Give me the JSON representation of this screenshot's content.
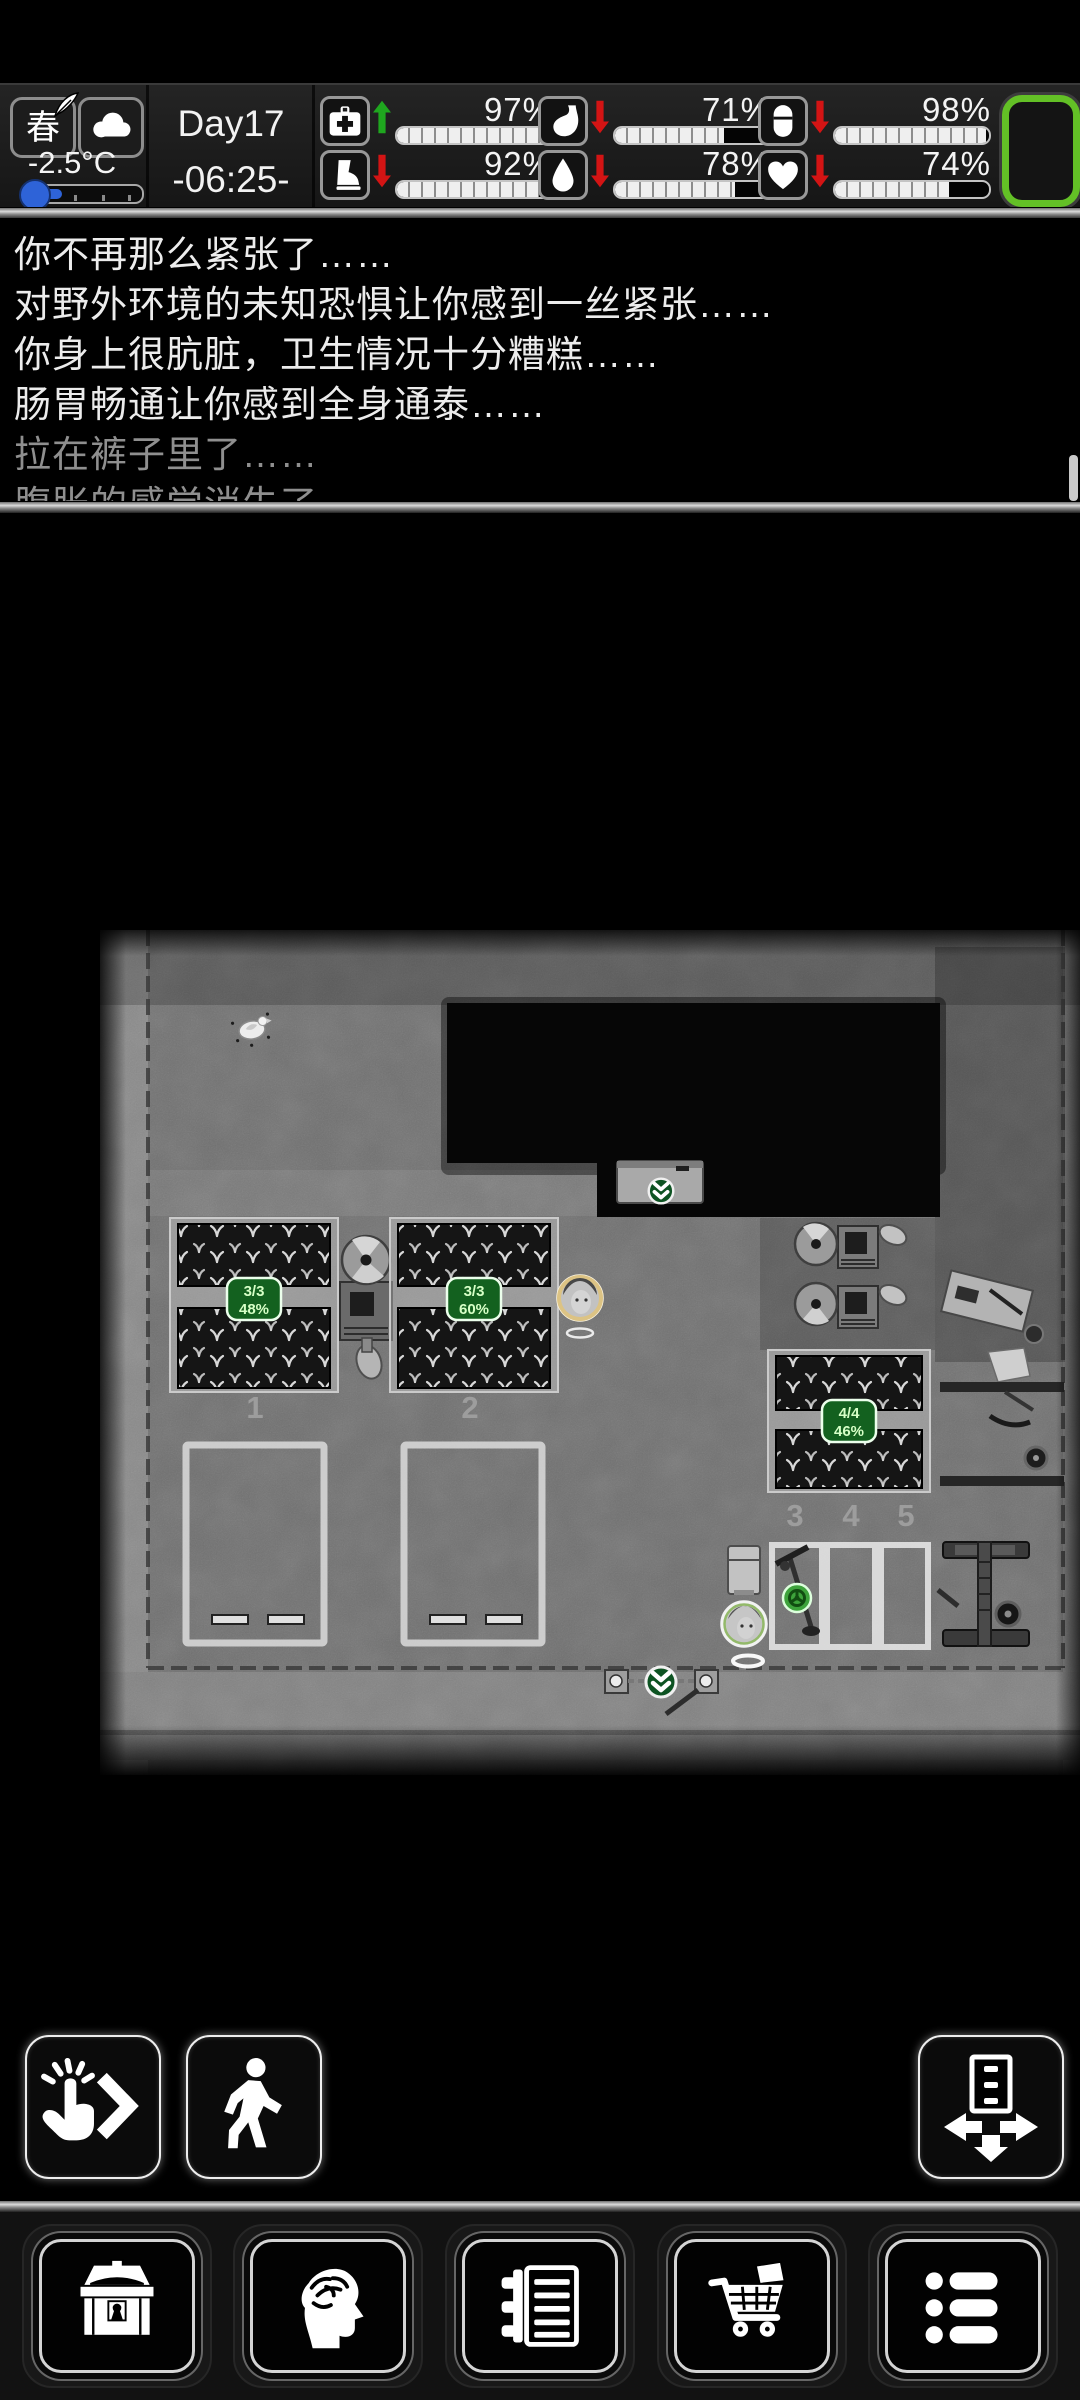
{
  "status_bar": {
    "season_button": {
      "label": "春",
      "icon": "quill-icon"
    },
    "weather_button": {
      "icon": "cloud-icon"
    },
    "temperature": "-2.5°C",
    "day": "Day17",
    "time": "-06:25-",
    "stats": [
      {
        "name": "health",
        "icon": "medkit-icon",
        "trend": "up",
        "percent": 97,
        "label": "97%"
      },
      {
        "name": "stamina",
        "icon": "boot-icon",
        "trend": "down",
        "percent": 92,
        "label": "92%"
      },
      {
        "name": "fullness",
        "icon": "stomach-icon",
        "trend": "down",
        "percent": 71,
        "label": "71%"
      },
      {
        "name": "hydration",
        "icon": "water-drop-icon",
        "trend": "down",
        "percent": 78,
        "label": "78%"
      },
      {
        "name": "energy",
        "icon": "capsule-icon",
        "trend": "down",
        "percent": 98,
        "label": "98%"
      },
      {
        "name": "mood",
        "icon": "heart-icon",
        "trend": "down",
        "percent": 74,
        "label": "74%"
      }
    ],
    "colors": {
      "trend_up": "#1fa71f",
      "trend_down": "#d31414",
      "battery_border": "#63c026"
    }
  },
  "message_log": {
    "lines": [
      {
        "text": "你不再那么紧张了……",
        "dim": false
      },
      {
        "text": "对野外环境的未知恐惧让你感到一丝紧张……",
        "dim": false
      },
      {
        "text": "你身上很肮脏，卫生情况十分糟糕……",
        "dim": false
      },
      {
        "text": "肠胃畅通让你感到全身通泰……",
        "dim": false
      },
      {
        "text": "拉在裤子里了……",
        "dim": true
      },
      {
        "text": "腹胀的感觉消失了",
        "dim": true
      }
    ]
  },
  "map": {
    "plots": [
      {
        "name": "plot-1",
        "count": "3/3",
        "growth": "48%"
      },
      {
        "name": "plot-2",
        "count": "3/3",
        "growth": "60%"
      },
      {
        "name": "plot-3",
        "count": "4/4",
        "growth": "46%"
      }
    ],
    "parking_spots": [
      "1",
      "2",
      "3",
      "4",
      "5"
    ],
    "badge_color": "#13611f"
  },
  "action_buttons": [
    {
      "name": "interact",
      "icon": "tap-chevron-icon"
    },
    {
      "name": "move",
      "icon": "walking-person-icon"
    },
    {
      "name": "storage-deploy",
      "icon": "drawer-arrows-icon"
    }
  ],
  "toolbar_buttons": [
    {
      "name": "inventory",
      "icon": "treasure-chest-icon"
    },
    {
      "name": "character",
      "icon": "head-brain-icon"
    },
    {
      "name": "journal",
      "icon": "notebook-icon"
    },
    {
      "name": "trade",
      "icon": "shopping-cart-icon"
    },
    {
      "name": "menu",
      "icon": "bullet-list-icon"
    }
  ]
}
